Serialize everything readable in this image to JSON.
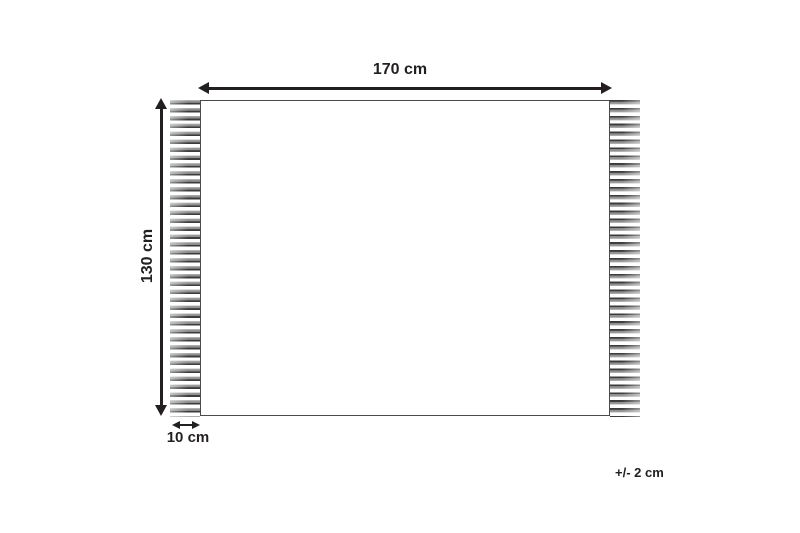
{
  "diagram": {
    "width_label": "170 cm",
    "height_label": "130 cm",
    "fringe_label": "10 cm",
    "tolerance_label": "+/- 2 cm",
    "colors": {
      "line": "#231f20",
      "outline": "#4a4a4a",
      "fringe_dark": "#3b3b3b",
      "fringe_mid": "#8f8f8f",
      "fringe_light": "#c2c2c2",
      "bg": "#ffffff"
    }
  }
}
